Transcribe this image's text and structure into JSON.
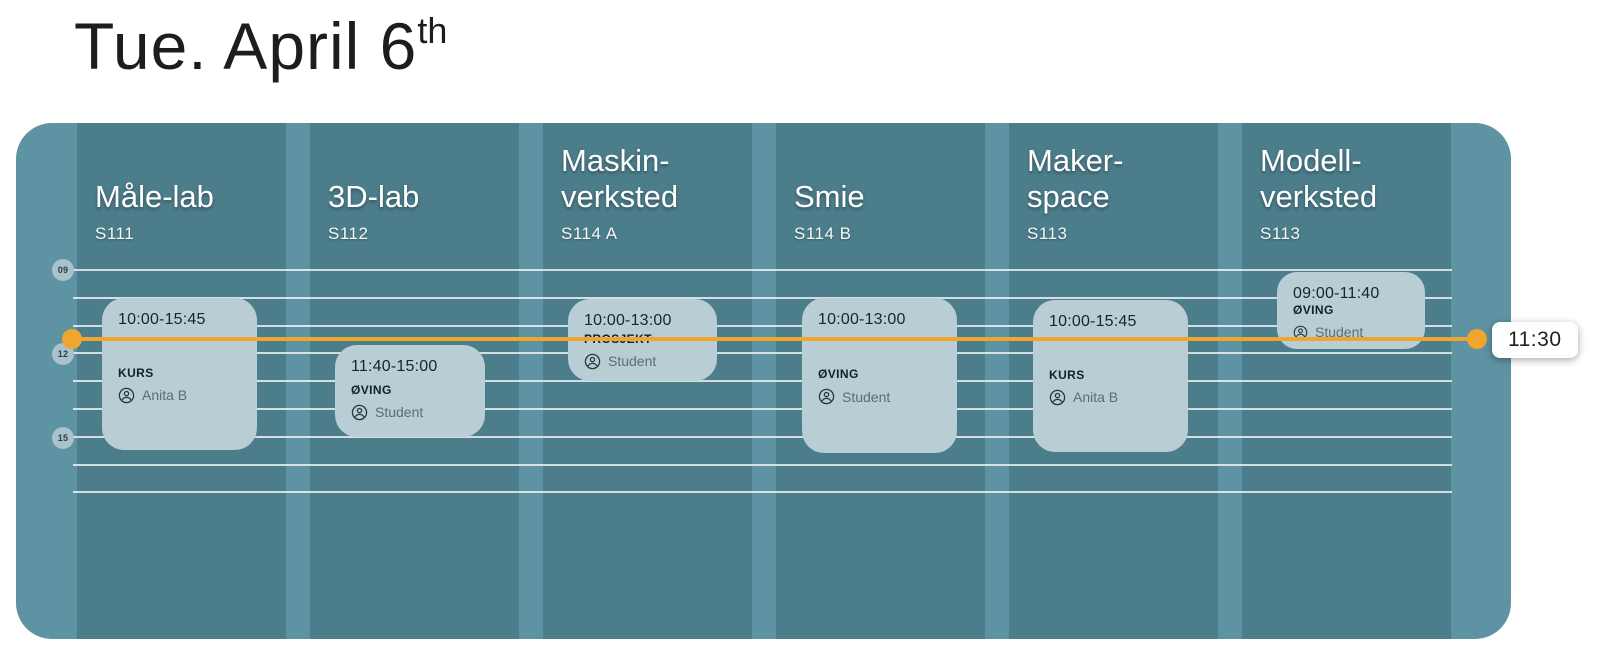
{
  "page": {
    "title": "Tue. April 6",
    "title_sup": "th"
  },
  "now": {
    "time": "11:30"
  },
  "time_axis": {
    "ticks": [
      "09",
      "12",
      "15"
    ]
  },
  "columns": [
    {
      "name": "Måle-lab",
      "room": "S111",
      "event": {
        "time": "10:00-15:45",
        "type": "KURS",
        "person": "Anita B"
      }
    },
    {
      "name": "3D-lab",
      "room": "S112",
      "event": {
        "time": "11:40-15:00",
        "type": "ØVING",
        "person": "Student"
      }
    },
    {
      "name": "Maskin-verksted",
      "room": "S114 A",
      "event": {
        "time": "10:00-13:00",
        "type": "PROSJEKT",
        "person": "Student"
      }
    },
    {
      "name": "Smie",
      "room": "S114 B",
      "event": {
        "time": "10:00-13:00",
        "type": "ØVING",
        "person": "Student"
      }
    },
    {
      "name": "Maker-space",
      "room": "S113",
      "event": {
        "time": "10:00-15:45",
        "type": "KURS",
        "person": "Anita B"
      }
    },
    {
      "name": "Modell-verksted",
      "room": "S113",
      "event": {
        "time": "09:00-11:40",
        "type": "ØVING",
        "person": "Student"
      }
    }
  ],
  "colors": {
    "container": "#5E93A3",
    "column": "#4C7D8B",
    "card": "#B9CDD5",
    "tick_circle": "#A9C2CC",
    "accent_orange": "#F0A52E"
  }
}
